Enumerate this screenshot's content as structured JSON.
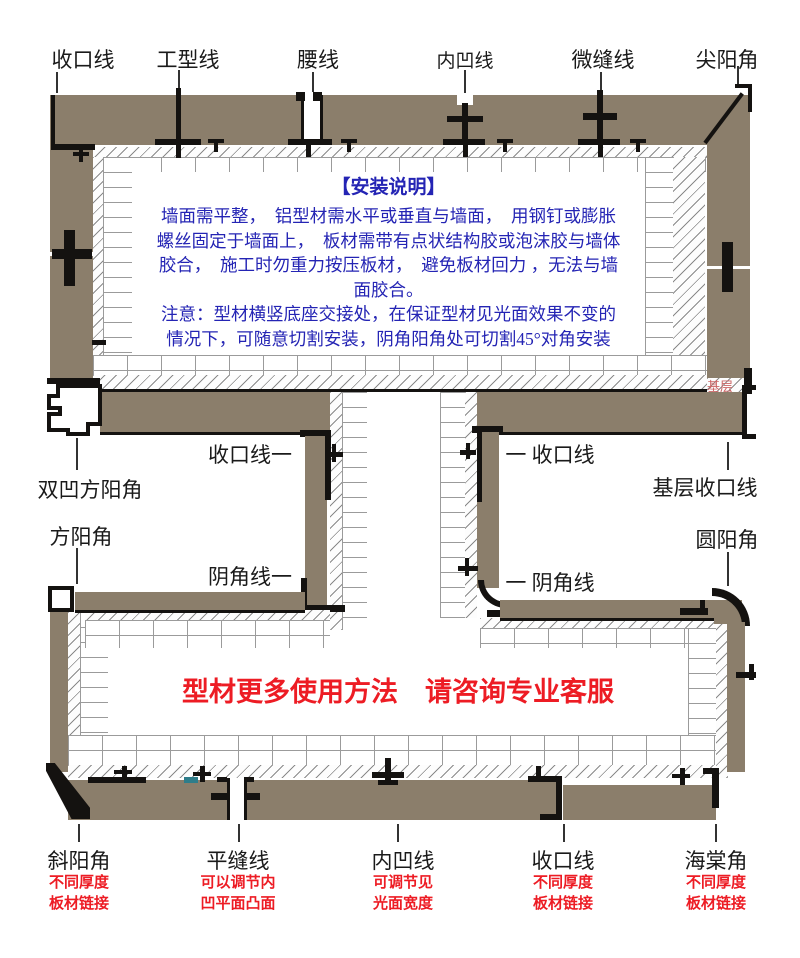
{
  "colors": {
    "panel": "#8b7e6b",
    "outline": "#141210",
    "blue_text": "#2424b4",
    "red_text": "#ed1c24",
    "base_label": "#cc6666",
    "mortar": "#9b9b9b"
  },
  "top_labels": [
    {
      "text": "收口线"
    },
    {
      "text": "工型线"
    },
    {
      "text": "腰线"
    },
    {
      "text": "内凹线"
    },
    {
      "text": "微缝线"
    },
    {
      "text": "尖阳角"
    }
  ],
  "install_note": {
    "title": "【安装说明】",
    "lines": [
      "墙面需平整，　铝型材需水平或垂直与墙面，　用钢钉或膨胀",
      "螺丝固定于墙面上，　板材需带有点状结构胶或泡沫胶与墙体",
      "胶合，　施工时勿重力按压板材，　避免板材回力 ，无法与墙",
      "面胶合。",
      "注意：型材横竖底座交接处，在保证型材见光面效果不变的",
      "情况下，可随意切割安装，阴角阳角处可切割45°对角安装"
    ]
  },
  "mid_labels": {
    "shoukou_left": "收口线一",
    "shoukou_right": "一 收口线",
    "jiceng_shoukou": "基层收口线",
    "shuang_ao_fang_yang_jiao": "双凹方阳角",
    "fang_yang_jiao": "方阳角",
    "yuan_yang_jiao": "圆阳角",
    "yin_jiao_left": "阴角线一",
    "yin_jiao_right": "一 阴角线",
    "jiceng": "基层"
  },
  "promo": "型材更多使用方法　请咨询专业客服",
  "bottom_items": [
    {
      "label": "斜阳角",
      "caption1": "不同厚度",
      "caption2": "板材链接"
    },
    {
      "label": "平缝线",
      "caption1": "可以调节内",
      "caption2": "凹平面凸面"
    },
    {
      "label": "内凹线",
      "caption1": "可调节见",
      "caption2": "光面宽度"
    },
    {
      "label": "收口线",
      "caption1": "不同厚度",
      "caption2": "板材链接"
    },
    {
      "label": "海棠角",
      "caption1": "不同厚度",
      "caption2": "板材链接"
    }
  ]
}
